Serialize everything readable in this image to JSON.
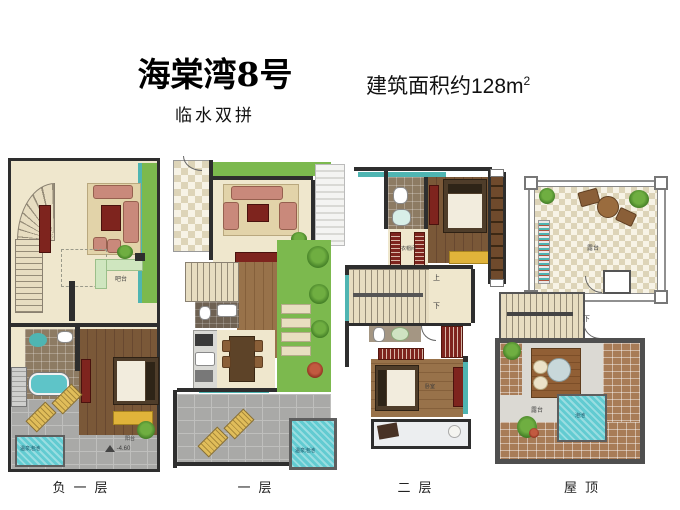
{
  "header": {
    "title": "海棠湾8号",
    "subtitle": "临水双拼",
    "area_label": "建筑面积约128m",
    "area_sup": "2"
  },
  "colors": {
    "wall": "#2e2e2e",
    "water": "#62cbd1",
    "garden_green": "#7cb94e",
    "wood_floor": "#7a5838",
    "terrace_tile": "#a9a9a7"
  },
  "plans": {
    "basement": {
      "label": "负一层",
      "rooms": {
        "bar": "吧台",
        "spa_pool": "温泉泡池",
        "balcony": "阳台",
        "elevation": "-4.60"
      }
    },
    "first": {
      "label": "一层",
      "rooms": {
        "spa_pool": "温泉泡池"
      }
    },
    "second": {
      "label": "二层",
      "rooms": {
        "closet": "衣帽间",
        "up": "上",
        "down": "下",
        "bedroom": "卧室"
      }
    },
    "roof": {
      "label": "屋顶",
      "rooms": {
        "terrace_top": "露台",
        "down": "下",
        "terrace_low": "露台",
        "pool": "泡池"
      }
    }
  }
}
